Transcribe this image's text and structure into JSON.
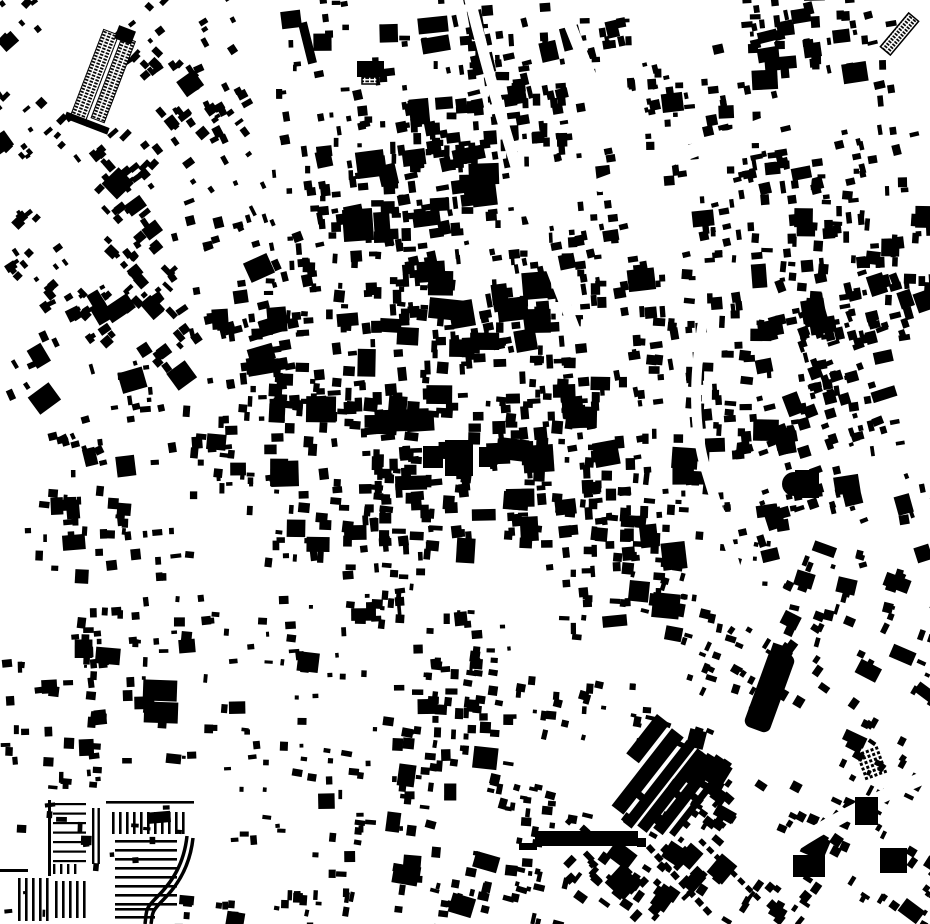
{
  "map": {
    "description": "black-and-white figure-ground map of urban building footprints",
    "background_color": "#ffffff",
    "building_color": "#000000",
    "road_color": "#ffffff",
    "width": 930,
    "height": 924,
    "seed": 1337,
    "fabric": {
      "cols": 10,
      "rows": 10,
      "density_levels": [
        3,
        10,
        20,
        34,
        50
      ],
      "density": [
        [
          1,
          2,
          1,
          2,
          3,
          3,
          2,
          2,
          3,
          2
        ],
        [
          2,
          3,
          2,
          2,
          4,
          4,
          1,
          2,
          3,
          2
        ],
        [
          2,
          3,
          2,
          3,
          4,
          2,
          2,
          2,
          3,
          3
        ],
        [
          2,
          3,
          3,
          3,
          4,
          4,
          3,
          3,
          3,
          3
        ],
        [
          1,
          2,
          3,
          4,
          4,
          4,
          3,
          3,
          3,
          2
        ],
        [
          2,
          2,
          2,
          3,
          4,
          3,
          4,
          2,
          3,
          2
        ],
        [
          0,
          2,
          1,
          2,
          2,
          1,
          3,
          2,
          2,
          2
        ],
        [
          2,
          2,
          1,
          1,
          3,
          2,
          2,
          2,
          2,
          2
        ],
        [
          2,
          1,
          1,
          2,
          2,
          2,
          1,
          3,
          2,
          2
        ],
        [
          0,
          0,
          1,
          2,
          2,
          3,
          3,
          2,
          2,
          2
        ]
      ],
      "angles": [
        [
          -40,
          -40,
          -30,
          -6,
          -6,
          -8,
          -8,
          -8,
          -8,
          -8
        ],
        [
          -40,
          -40,
          -30,
          -6,
          -6,
          -6,
          -8,
          -8,
          -8,
          -8
        ],
        [
          -40,
          -40,
          -20,
          -6,
          -6,
          -6,
          -8,
          -8,
          0,
          0
        ],
        [
          -30,
          -40,
          -10,
          0,
          0,
          -5,
          -5,
          0,
          -15,
          -15
        ],
        [
          -20,
          -10,
          0,
          0,
          0,
          0,
          -5,
          0,
          -15,
          -15
        ],
        [
          0,
          0,
          0,
          0,
          0,
          0,
          0,
          0,
          -15,
          -15
        ],
        [
          0,
          0,
          0,
          0,
          0,
          0,
          0,
          10,
          20,
          20
        ],
        [
          0,
          0,
          0,
          0,
          5,
          5,
          10,
          20,
          30,
          30
        ],
        [
          0,
          0,
          0,
          5,
          5,
          10,
          35,
          35,
          30,
          30
        ],
        [
          0,
          0,
          5,
          5,
          10,
          10,
          40,
          40,
          35,
          35
        ]
      ],
      "size_min": 3.5,
      "size_range": 7.5,
      "big_chance": 0.08,
      "angle_jitter": 14
    },
    "roads": [
      {
        "d": "M560,0 L640,200",
        "width": 12
      },
      {
        "d": "M470,0 C490,80 505,130 520,180 S560,290 575,330",
        "width": 11
      },
      {
        "d": "M705,310 C692,380 694,430 706,470 S738,570 748,614",
        "width": 10
      },
      {
        "d": "M700,924 C740,880 800,830 930,775",
        "width": 13
      },
      {
        "d": "M600,185 L830,100",
        "width": 14
      }
    ],
    "landmarks": [
      {
        "name": "block-a",
        "x": 357,
        "y": 61,
        "w": 27,
        "h": 16,
        "rot": 0
      },
      {
        "name": "block-a-annex",
        "x": 362,
        "y": 77,
        "w": 15,
        "h": 7,
        "rot": 0,
        "hatch": true
      },
      {
        "name": "block-b",
        "x": 418,
        "y": 17,
        "w": 30,
        "h": 16,
        "rot": -6
      },
      {
        "name": "block-c1",
        "x": 343,
        "y": 209,
        "w": 30,
        "h": 32,
        "rot": -4
      },
      {
        "name": "block-c2",
        "x": 374,
        "y": 212,
        "w": 16,
        "h": 26,
        "rot": -4
      },
      {
        "name": "center-block-1",
        "x": 423,
        "y": 446,
        "w": 20,
        "h": 22,
        "rot": 0
      },
      {
        "name": "center-block-2",
        "x": 445,
        "y": 440,
        "w": 28,
        "h": 36,
        "rot": 0
      },
      {
        "name": "center-block-3",
        "x": 479,
        "y": 447,
        "w": 14,
        "h": 20,
        "rot": 0
      },
      {
        "name": "east-block",
        "x": 795,
        "y": 470,
        "w": 24,
        "h": 28,
        "rot": 0
      },
      {
        "name": "east-block-dome",
        "circle": true,
        "cx": 794,
        "cy": 484,
        "r": 12
      },
      {
        "name": "twin-square-1",
        "x": 143,
        "y": 680,
        "w": 34,
        "h": 21,
        "rot": 2
      },
      {
        "name": "twin-square-2",
        "x": 144,
        "y": 702,
        "w": 34,
        "h": 21,
        "rot": 2
      },
      {
        "name": "long-bar-left",
        "x": 519,
        "y": 843,
        "w": 18,
        "h": 7,
        "rot": 0
      },
      {
        "name": "long-bar",
        "x": 535,
        "y": 831,
        "w": 103,
        "h": 15,
        "rot": 0
      },
      {
        "name": "long-bar-right",
        "x": 637,
        "y": 838,
        "w": 9,
        "h": 9,
        "rot": 0
      },
      {
        "name": "tilted-hall",
        "x": 756,
        "y": 650,
        "w": 27,
        "h": 82,
        "rot": 20,
        "rx": 7
      },
      {
        "name": "pentagon-block",
        "x": 712,
        "y": 857,
        "w": 20,
        "h": 24,
        "rot": 40
      },
      {
        "name": "se-block-1",
        "x": 855,
        "y": 797,
        "w": 23,
        "h": 28,
        "rot": 0
      },
      {
        "name": "se-block-2",
        "x": 793,
        "y": 855,
        "w": 32,
        "h": 22,
        "rot": 0
      },
      {
        "name": "se-block-3",
        "x": 880,
        "y": 848,
        "w": 27,
        "h": 25,
        "rot": 0
      },
      {
        "name": "ne-hatch-bar",
        "x": 893,
        "y": 12,
        "w": 13,
        "h": 44,
        "rot": 40,
        "hatch": true
      },
      {
        "name": "nw-thin-bar",
        "x": 303,
        "y": 22,
        "w": 9,
        "h": 42,
        "rot": -14
      }
    ],
    "industrial_complex": {
      "cx": 106,
      "cy": 79,
      "rot": 21,
      "bars": [
        {
          "dx": -12,
          "dy": 0,
          "w": 17,
          "h": 92
        },
        {
          "dx": 7,
          "dy": -2,
          "w": 15,
          "h": 88
        }
      ],
      "solids": [
        {
          "dx": -2,
          "dy": 48,
          "w": 46,
          "h": 7
        },
        {
          "dx": 2,
          "dy": -48,
          "w": 18,
          "h": 14
        }
      ]
    },
    "warehouse_cluster": {
      "cx": 665,
      "cy": 785,
      "rot": 38,
      "bars": [
        {
          "dx": -42,
          "dy": -26,
          "w": 16,
          "h": 50
        },
        {
          "dx": -22,
          "dy": 0,
          "w": 15,
          "h": 98
        },
        {
          "dx": -5,
          "dy": 3,
          "w": 11,
          "h": 104
        },
        {
          "dx": 9,
          "dy": 0,
          "w": 12,
          "h": 98
        },
        {
          "dx": 23,
          "dy": -3,
          "w": 12,
          "h": 88
        },
        {
          "dx": 36,
          "dy": -6,
          "w": 7,
          "h": 82
        }
      ]
    },
    "strip_groups": [
      {
        "x": 53,
        "y": 803,
        "count": 7,
        "step": 9.5,
        "len": 33,
        "thick": 2.2,
        "dir": "h"
      },
      {
        "x": 48,
        "y": 800,
        "count": 1,
        "step": 0,
        "len": 76,
        "thick": 3,
        "dir": "v"
      },
      {
        "x": 92,
        "y": 808,
        "count": 2,
        "step": 5.5,
        "len": 56,
        "thick": 2.4,
        "dir": "v"
      },
      {
        "x": 18,
        "y": 878,
        "count": 5,
        "step": 7,
        "len": 43,
        "thick": 2.6,
        "dir": "v"
      },
      {
        "x": 55,
        "y": 881,
        "count": 5,
        "step": 7,
        "len": 37,
        "thick": 2.6,
        "dir": "v"
      },
      {
        "x": 0,
        "y": 869,
        "count": 1,
        "step": 0,
        "len": 28,
        "thick": 3,
        "dir": "h"
      },
      {
        "x": 112,
        "y": 812,
        "count": 11,
        "step": 7,
        "len": 22,
        "thick": 2.6,
        "dir": "v"
      },
      {
        "x": 115,
        "y": 840,
        "count": 8,
        "step": 9,
        "len": 62,
        "thick": 2.6,
        "dir": "h"
      },
      {
        "x": 115,
        "y": 908,
        "count": 2,
        "step": 8,
        "len": 40,
        "thick": 2.6,
        "dir": "h"
      },
      {
        "x": 106,
        "y": 801,
        "count": 1,
        "step": 0,
        "len": 88,
        "thick": 2.6,
        "dir": "h"
      },
      {
        "x": 53,
        "y": 864,
        "count": 4,
        "step": 7,
        "len": 10,
        "thick": 2.4,
        "dir": "v"
      }
    ],
    "curves": [
      {
        "d": "M187,836 C184,864 172,882 158,896 S147,910 145,924",
        "width": 3.5
      },
      {
        "d": "M193,838 C190,866 178,885 164,899 S153,913 151,924",
        "width": 3.5
      },
      {
        "d": "M648,846 L712,916",
        "width": 6,
        "dash": "8 4"
      },
      {
        "d": "M700,840 L760,900",
        "width": 5,
        "dash": "7 4"
      }
    ],
    "dot_grids": [
      {
        "x": 856,
        "y": 754,
        "rows": 6,
        "cols": 5,
        "size": 3,
        "step": 5,
        "rot": -20
      }
    ]
  }
}
